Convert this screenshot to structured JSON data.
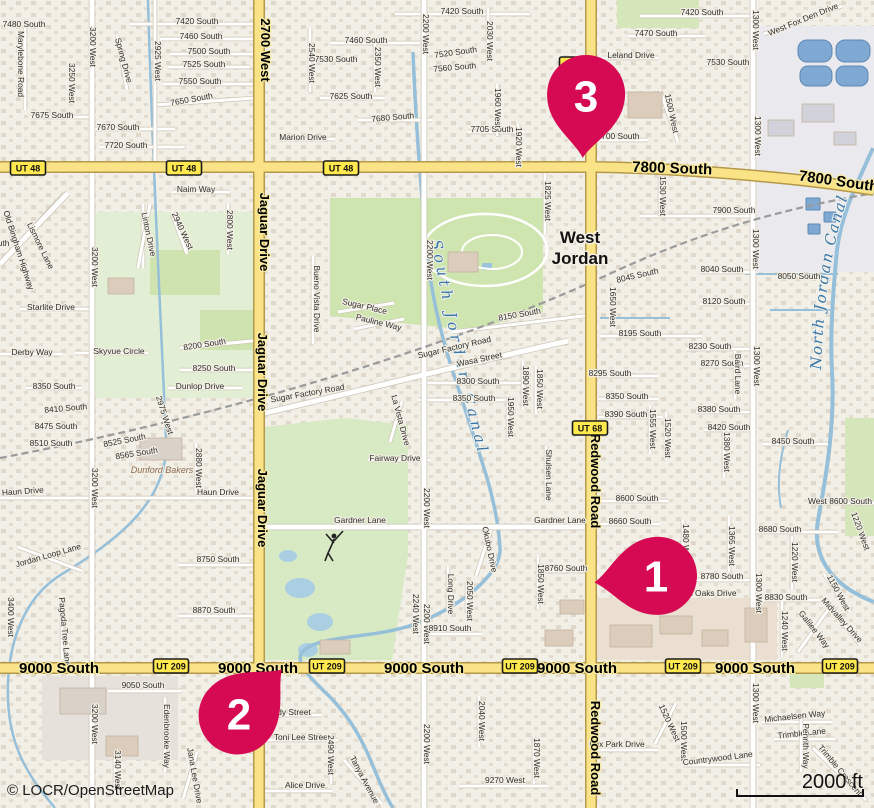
{
  "map": {
    "attribution": "© LOCR/OpenStreetMap",
    "scale_label": "2000 ft",
    "city": {
      "line1": "West",
      "line2": "Jordan"
    },
    "colors": {
      "marker": "#d50a53",
      "major_road": "#fae387",
      "shield_bg": "#ffe94e",
      "water": "#96bfd9"
    },
    "markers": [
      {
        "label": "1",
        "x": 656,
        "y": 576,
        "rot": 84
      },
      {
        "label": "2",
        "x": 239,
        "y": 714,
        "rot": -136
      },
      {
        "label": "3",
        "x": 586,
        "y": 96,
        "rot": 3
      }
    ],
    "shields": [
      {
        "t": "UT 48",
        "x": 28,
        "y": 168
      },
      {
        "t": "UT 48",
        "x": 184,
        "y": 168
      },
      {
        "t": "UT 48",
        "x": 341,
        "y": 168
      },
      {
        "t": "UT 48",
        "x": 577,
        "y": 64
      },
      {
        "t": "UT 68",
        "x": 590,
        "y": 428
      },
      {
        "t": "UT 209",
        "x": 171,
        "y": 666
      },
      {
        "t": "UT 209",
        "x": 327,
        "y": 666
      },
      {
        "t": "UT 209",
        "x": 520,
        "y": 666
      },
      {
        "t": "UT 209",
        "x": 683,
        "y": 666
      },
      {
        "t": "UT 209",
        "x": 840,
        "y": 666
      }
    ],
    "road_labels": [
      {
        "t": "7800 South",
        "x": 672,
        "y": 173,
        "r": 2
      },
      {
        "t": "7800 South",
        "x": 838,
        "y": 186,
        "r": 8
      },
      {
        "t": "9000 South",
        "x": 59,
        "y": 673
      },
      {
        "t": "9000 South",
        "x": 258,
        "y": 673
      },
      {
        "t": "9000 South",
        "x": 424,
        "y": 673
      },
      {
        "t": "9000 South",
        "x": 577,
        "y": 673
      },
      {
        "t": "9000 South",
        "x": 755,
        "y": 673
      },
      {
        "t": "2700 West",
        "x": 261,
        "y": 50,
        "r": 90
      },
      {
        "t": "Jaguar Drive",
        "x": 260,
        "y": 232,
        "r": 90
      },
      {
        "t": "Jaguar Drive",
        "x": 258,
        "y": 372,
        "r": 90
      },
      {
        "t": "Jaguar Drive",
        "x": 258,
        "y": 508,
        "r": 90
      },
      {
        "t": "Redwood Road",
        "x": 591,
        "y": 481,
        "r": 90
      },
      {
        "t": "Redwood Road",
        "x": 591,
        "y": 748,
        "r": 90
      }
    ],
    "canal_labels": {
      "south": "South Jordan Canal",
      "north": "North Jordan Canal"
    },
    "poi_labels": [
      {
        "t": "Dunford Bakers",
        "x": 162,
        "y": 473
      }
    ],
    "street_labels": [
      {
        "t": "7480 South",
        "x": 24,
        "y": 27
      },
      {
        "t": "Marylebone Road",
        "x": 18,
        "y": 64,
        "r": 90
      },
      {
        "t": "3200 West",
        "x": 90,
        "y": 47,
        "r": 90
      },
      {
        "t": "3250 West",
        "x": 69,
        "y": 83,
        "r": 90
      },
      {
        "t": "Spring Drive",
        "x": 121,
        "y": 61,
        "r": 75
      },
      {
        "t": "2925 West",
        "x": 155,
        "y": 61,
        "r": 90
      },
      {
        "t": "7420 South",
        "x": 197,
        "y": 24
      },
      {
        "t": "7460 South",
        "x": 201,
        "y": 39
      },
      {
        "t": "7500 South",
        "x": 209,
        "y": 54
      },
      {
        "t": "7525 South",
        "x": 204,
        "y": 67
      },
      {
        "t": "7550 South",
        "x": 200,
        "y": 84
      },
      {
        "t": "7650 South",
        "x": 192,
        "y": 102,
        "r": -10
      },
      {
        "t": "7675 South",
        "x": 52,
        "y": 118
      },
      {
        "t": "7670 South",
        "x": 118,
        "y": 130
      },
      {
        "t": "7720 South",
        "x": 126,
        "y": 148
      },
      {
        "t": "Naim Way",
        "x": 196,
        "y": 192
      },
      {
        "t": "Marion Drive",
        "x": 303,
        "y": 140
      },
      {
        "t": "7420 South",
        "x": 462,
        "y": 14
      },
      {
        "t": "7460 South",
        "x": 366,
        "y": 43
      },
      {
        "t": "7530 South",
        "x": 336,
        "y": 62
      },
      {
        "t": "2540 West",
        "x": 309,
        "y": 63,
        "r": 90
      },
      {
        "t": "2350 West",
        "x": 375,
        "y": 67,
        "r": 90
      },
      {
        "t": "2200 West",
        "x": 423,
        "y": 34,
        "r": 90
      },
      {
        "t": "7520 South",
        "x": 456,
        "y": 55,
        "r": -8
      },
      {
        "t": "7560 South",
        "x": 455,
        "y": 70,
        "r": -5
      },
      {
        "t": "2030 West",
        "x": 487,
        "y": 41,
        "r": 90
      },
      {
        "t": "7625 South",
        "x": 351,
        "y": 99
      },
      {
        "t": "7680 South",
        "x": 393,
        "y": 120,
        "r": -5
      },
      {
        "t": "7705 South",
        "x": 492,
        "y": 132
      },
      {
        "t": "1960 West",
        "x": 495,
        "y": 108,
        "r": 90
      },
      {
        "t": "1920 West",
        "x": 516,
        "y": 147,
        "r": 90
      },
      {
        "t": "1825 West",
        "x": 545,
        "y": 201,
        "r": 90
      },
      {
        "t": "7470 South",
        "x": 656,
        "y": 36
      },
      {
        "t": "Leland Drive",
        "x": 631,
        "y": 58
      },
      {
        "t": "7420 South",
        "x": 702,
        "y": 15
      },
      {
        "t": "7530 South",
        "x": 728,
        "y": 65
      },
      {
        "t": "1300 West",
        "x": 753,
        "y": 30,
        "r": 90
      },
      {
        "t": "West Fox Den Drive",
        "x": 804,
        "y": 22,
        "r": -22
      },
      {
        "t": "1300 West",
        "x": 755,
        "y": 136,
        "r": 90
      },
      {
        "t": "1500 West",
        "x": 669,
        "y": 114,
        "r": 78
      },
      {
        "t": "7700 South",
        "x": 618,
        "y": 139
      },
      {
        "t": "1530 West",
        "x": 660,
        "y": 196,
        "r": 90
      },
      {
        "t": "3375 South",
        "x": -12,
        "y": 246
      },
      {
        "t": "Old Bingham Highway",
        "x": 16,
        "y": 251,
        "r": 72
      },
      {
        "t": "Lismore Lane",
        "x": 38,
        "y": 247,
        "r": 64
      },
      {
        "t": "3200 West",
        "x": 92,
        "y": 267,
        "r": 90
      },
      {
        "t": "Linton Drive",
        "x": 146,
        "y": 235,
        "r": 78
      },
      {
        "t": "2940 West",
        "x": 180,
        "y": 232,
        "r": 65
      },
      {
        "t": "2800 West",
        "x": 227,
        "y": 230,
        "r": 90
      },
      {
        "t": "Starlite Drive",
        "x": 51,
        "y": 310
      },
      {
        "t": "Derby Way",
        "x": 32,
        "y": 355
      },
      {
        "t": "Skyvue Circle",
        "x": 119,
        "y": 354
      },
      {
        "t": "8200 South",
        "x": 205,
        "y": 347,
        "r": -9
      },
      {
        "t": "8250 South",
        "x": 214,
        "y": 371
      },
      {
        "t": "Dunlop Drive",
        "x": 200,
        "y": 389
      },
      {
        "t": "8350 South",
        "x": 54,
        "y": 389
      },
      {
        "t": "Bueno Vista Drive",
        "x": 314,
        "y": 299,
        "r": 90
      },
      {
        "t": "Sugar Place",
        "x": 364,
        "y": 309,
        "r": 13
      },
      {
        "t": "Pauline Way",
        "x": 378,
        "y": 325,
        "r": 14
      },
      {
        "t": "2200 West",
        "x": 427,
        "y": 260,
        "r": 90
      },
      {
        "t": "8150 South",
        "x": 520,
        "y": 317,
        "r": -10
      },
      {
        "t": "Sugar Factory Road",
        "x": 455,
        "y": 350,
        "r": -13
      },
      {
        "t": "Sugar Factory Road",
        "x": 308,
        "y": 396,
        "r": -10
      },
      {
        "t": "Wasa Street",
        "x": 480,
        "y": 362,
        "r": -12
      },
      {
        "t": "8300 South",
        "x": 478,
        "y": 384
      },
      {
        "t": "8350 South",
        "x": 474,
        "y": 401
      },
      {
        "t": "1890 West",
        "x": 523,
        "y": 386,
        "r": 90
      },
      {
        "t": "1850 West",
        "x": 537,
        "y": 389,
        "r": 90
      },
      {
        "t": "1950 West",
        "x": 508,
        "y": 417,
        "r": 90
      },
      {
        "t": "7900 South",
        "x": 734,
        "y": 213
      },
      {
        "t": "8040 South",
        "x": 722,
        "y": 272
      },
      {
        "t": "8045 South",
        "x": 638,
        "y": 278,
        "r": -13
      },
      {
        "t": "1650 West",
        "x": 610,
        "y": 307,
        "r": 90
      },
      {
        "t": "8050 South",
        "x": 799,
        "y": 279
      },
      {
        "t": "8120 South",
        "x": 724,
        "y": 304
      },
      {
        "t": "8195 South",
        "x": 640,
        "y": 336
      },
      {
        "t": "1300 West",
        "x": 753,
        "y": 249,
        "r": 90
      },
      {
        "t": "8230 South",
        "x": 710,
        "y": 349
      },
      {
        "t": "8270 South",
        "x": 722,
        "y": 366
      },
      {
        "t": "1300 West",
        "x": 754,
        "y": 366,
        "r": 90
      },
      {
        "t": "Baird Lane",
        "x": 735,
        "y": 374,
        "r": 90
      },
      {
        "t": "8380 South",
        "x": 719,
        "y": 412
      },
      {
        "t": "8390 South",
        "x": 626,
        "y": 417
      },
      {
        "t": "8350 South",
        "x": 627,
        "y": 399
      },
      {
        "t": "8295 South",
        "x": 610,
        "y": 376
      },
      {
        "t": "1555 West",
        "x": 650,
        "y": 429,
        "r": 90
      },
      {
        "t": "1520 West",
        "x": 665,
        "y": 438,
        "r": 90
      },
      {
        "t": "8420 South",
        "x": 729,
        "y": 430
      },
      {
        "t": "1380 West",
        "x": 724,
        "y": 452,
        "r": 90
      },
      {
        "t": "8450 South",
        "x": 793,
        "y": 444
      },
      {
        "t": "8600 South",
        "x": 637,
        "y": 501
      },
      {
        "t": "West 8600 South",
        "x": 840,
        "y": 504
      },
      {
        "t": "8660 South",
        "x": 630,
        "y": 524
      },
      {
        "t": "8680 South",
        "x": 780,
        "y": 532
      },
      {
        "t": "1365 West",
        "x": 729,
        "y": 546,
        "r": 90
      },
      {
        "t": "1220 West",
        "x": 792,
        "y": 562,
        "r": 90
      },
      {
        "t": "1220 West",
        "x": 858,
        "y": 532,
        "r": 70
      },
      {
        "t": "1300 West",
        "x": 756,
        "y": 593,
        "r": 90
      },
      {
        "t": "8760 South",
        "x": 566,
        "y": 571
      },
      {
        "t": "8780 South",
        "x": 722,
        "y": 579
      },
      {
        "t": "Twin Oaks Drive",
        "x": 706,
        "y": 596
      },
      {
        "t": "8830 South",
        "x": 786,
        "y": 600
      },
      {
        "t": "1150 West",
        "x": 836,
        "y": 594,
        "r": 62
      },
      {
        "t": "Midvalley Drive",
        "x": 840,
        "y": 622,
        "r": 48
      },
      {
        "t": "1480 West",
        "x": 683,
        "y": 544,
        "r": 90
      },
      {
        "t": "La Vista Drive",
        "x": 398,
        "y": 421,
        "r": 75
      },
      {
        "t": "Fairway Drive",
        "x": 395,
        "y": 461
      },
      {
        "t": "2200 West",
        "x": 424,
        "y": 508,
        "r": 90
      },
      {
        "t": "Shulsen Lane",
        "x": 546,
        "y": 475,
        "r": 90
      },
      {
        "t": "Gardner Lane",
        "x": 360,
        "y": 523
      },
      {
        "t": "Gardner Lane",
        "x": 560,
        "y": 523
      },
      {
        "t": "Okubo Drive",
        "x": 487,
        "y": 550,
        "r": 78
      },
      {
        "t": "Long Drive",
        "x": 448,
        "y": 594,
        "r": 90
      },
      {
        "t": "2050 West",
        "x": 467,
        "y": 601,
        "r": 90
      },
      {
        "t": "1850 West",
        "x": 538,
        "y": 584,
        "r": 90
      },
      {
        "t": "8410 South",
        "x": 66,
        "y": 411,
        "r": -5
      },
      {
        "t": "8475 South",
        "x": 56,
        "y": 429
      },
      {
        "t": "8510 South",
        "x": 51,
        "y": 446
      },
      {
        "t": "8525 South",
        "x": 125,
        "y": 443,
        "r": -11
      },
      {
        "t": "8565 South",
        "x": 137,
        "y": 456,
        "r": -9
      },
      {
        "t": "2975 West",
        "x": 162,
        "y": 416,
        "r": 72
      },
      {
        "t": "2880 West",
        "x": 196,
        "y": 468,
        "r": 90
      },
      {
        "t": "Haun Drive",
        "x": 23,
        "y": 494,
        "r": -4
      },
      {
        "t": "Haun Drive",
        "x": 218,
        "y": 495
      },
      {
        "t": "3200 West",
        "x": 92,
        "y": 488,
        "r": 90
      },
      {
        "t": "Jordan Loop Lane",
        "x": 49,
        "y": 558,
        "r": -16
      },
      {
        "t": "8750 South",
        "x": 218,
        "y": 562
      },
      {
        "t": "3400 West",
        "x": 8,
        "y": 617,
        "r": 90
      },
      {
        "t": "8870 South",
        "x": 214,
        "y": 613
      },
      {
        "t": "Pagoda Tree Lane",
        "x": 62,
        "y": 632,
        "r": 85
      },
      {
        "t": "9050 South",
        "x": 143,
        "y": 688
      },
      {
        "t": "3200 West",
        "x": 92,
        "y": 724,
        "r": 90
      },
      {
        "t": "Edenbrooke Way",
        "x": 164,
        "y": 736,
        "r": 90
      },
      {
        "t": "3140 West",
        "x": 115,
        "y": 770,
        "r": 90
      },
      {
        "t": "Jana Lee Drive",
        "x": 192,
        "y": 776,
        "r": 80
      },
      {
        "t": "dy Street",
        "x": 294,
        "y": 715
      },
      {
        "t": "Toni Lee Street",
        "x": 302,
        "y": 740
      },
      {
        "t": "Alice Drive",
        "x": 305,
        "y": 788
      },
      {
        "t": "2490 West",
        "x": 328,
        "y": 755,
        "r": 90
      },
      {
        "t": "Tanya Avenue",
        "x": 362,
        "y": 781,
        "r": 62
      },
      {
        "t": "2240 West",
        "x": 413,
        "y": 614,
        "r": 90
      },
      {
        "t": "2200 West",
        "x": 424,
        "y": 624,
        "r": 90
      },
      {
        "t": "8910 South",
        "x": 450,
        "y": 631
      },
      {
        "t": "2040 West",
        "x": 479,
        "y": 721,
        "r": 90
      },
      {
        "t": "2200 West",
        "x": 424,
        "y": 744,
        "r": 90
      },
      {
        "t": "1870 West",
        "x": 534,
        "y": 758,
        "r": 90
      },
      {
        "t": "9270 West",
        "x": 505,
        "y": 783
      },
      {
        "t": "Fox Park Drive",
        "x": 617,
        "y": 747
      },
      {
        "t": "1520 West",
        "x": 667,
        "y": 724,
        "r": 65
      },
      {
        "t": "1500 West",
        "x": 681,
        "y": 741,
        "r": 90
      },
      {
        "t": "Countrywood Lane",
        "x": 718,
        "y": 761,
        "r": -7
      },
      {
        "t": "1300 West",
        "x": 753,
        "y": 703,
        "r": 90
      },
      {
        "t": "1240 West",
        "x": 782,
        "y": 631,
        "r": 90
      },
      {
        "t": "Galilee Way",
        "x": 812,
        "y": 631,
        "r": 52
      },
      {
        "t": "Michaelsen Way",
        "x": 795,
        "y": 719,
        "r": -6
      },
      {
        "t": "Trimble Lane",
        "x": 802,
        "y": 736,
        "r": -6
      },
      {
        "t": "Trimble Crescent",
        "x": 838,
        "y": 772,
        "r": 50
      },
      {
        "t": "Penrith Way",
        "x": 803,
        "y": 746,
        "r": 90
      }
    ]
  }
}
